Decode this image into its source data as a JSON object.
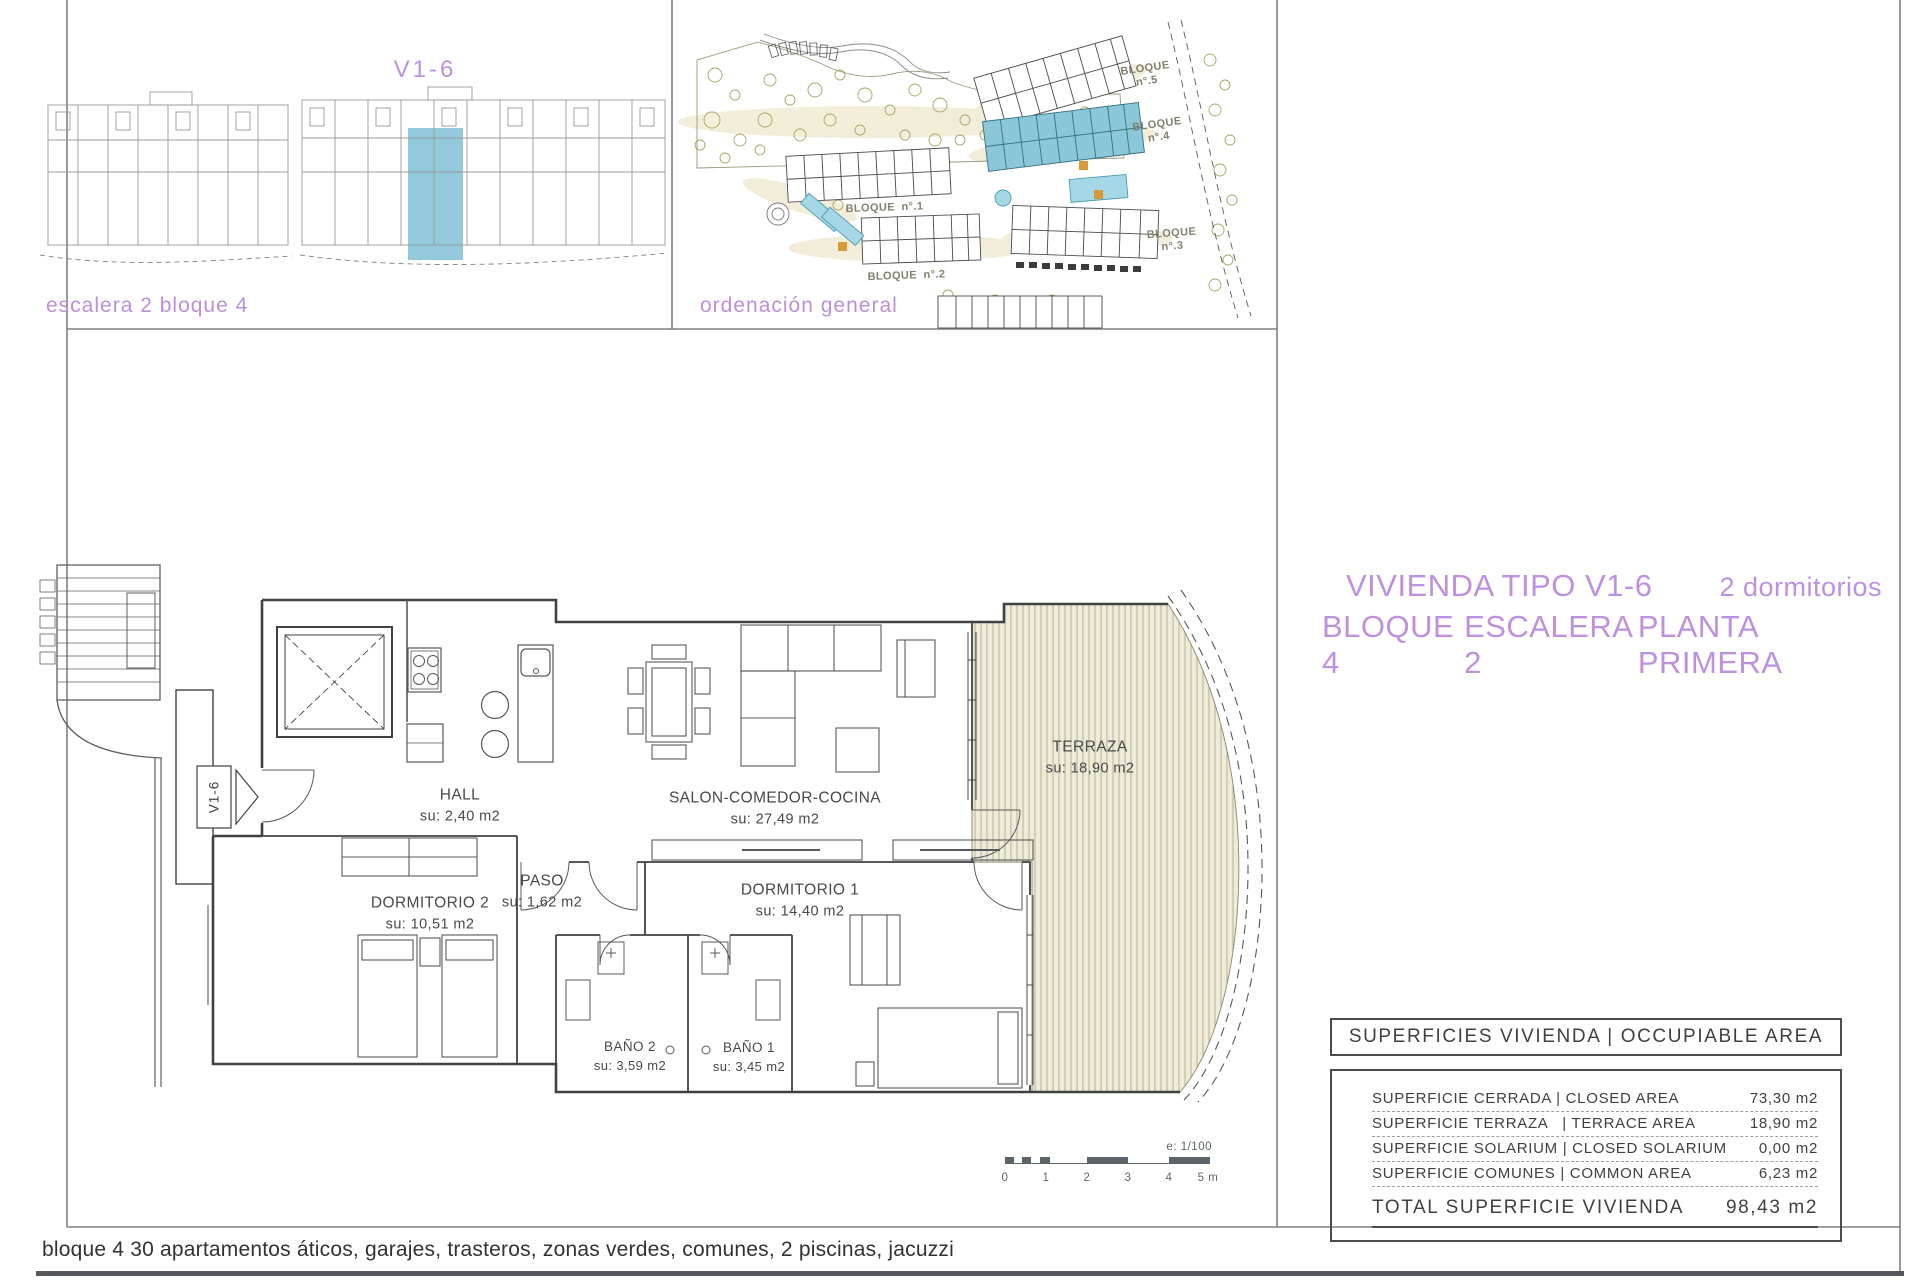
{
  "colors": {
    "accent_purple": "#bd90e0",
    "highlight_blue": "#89c6d8",
    "terrace_fill": "#efebdb",
    "terrace_hatch": "#b7b18c",
    "ink": "#3f4244",
    "scalebar": "#5a646a"
  },
  "locator_panel": {
    "unit_code": "V1-6",
    "caption": "escalera 2 bloque 4"
  },
  "site_panel": {
    "caption": "ordenación general",
    "blocks": [
      {
        "name": "BLOQUE",
        "no": "n°.5"
      },
      {
        "name": "BLOQUE",
        "no": "n°.4"
      },
      {
        "name": "BLOQUE",
        "no": "n°.1"
      },
      {
        "name": "BLOQUE",
        "no": "n°.2"
      },
      {
        "name": "BLOQUE",
        "no": "n°.3"
      }
    ]
  },
  "title": {
    "type_line": "VIVIENDA TIPO V1-6",
    "bedrooms": "2 dormitorios",
    "location_parts": [
      "BLOQUE 4",
      "ESCALERA 2",
      "PLANTA PRIMERA"
    ]
  },
  "floor_plan": {
    "marker": "V1-6",
    "rooms": {
      "hall": {
        "name": "HALL",
        "area": "su: 2,40 m2"
      },
      "salon": {
        "name": "SALON-COMEDOR-COCINA",
        "area": "su: 27,49 m2"
      },
      "terraza": {
        "name": "TERRAZA",
        "area": "su: 18,90 m2"
      },
      "dormitorio2": {
        "name": "DORMITORIO 2",
        "area": "su: 10,51 m2"
      },
      "paso": {
        "name": "PASO",
        "area": "su: 1,62 m2"
      },
      "dormitorio1": {
        "name": "DORMITORIO 1",
        "area": "su: 14,40 m2"
      },
      "bano2": {
        "name": "BAÑO 2",
        "area": "su: 3,59 m2"
      },
      "bano1": {
        "name": "BAÑO 1",
        "area": "su: 3,45 m2"
      }
    },
    "scale": {
      "ratio": "e: 1/100",
      "ticks": [
        "0",
        "1",
        "2",
        "3",
        "4",
        "5 m"
      ]
    }
  },
  "areas_table": {
    "header": "SUPERFICIES VIVIENDA | OCCUPIABLE AREA",
    "rows": [
      {
        "label": "SUPERFICIE CERRADA | CLOSED AREA",
        "value": "73,30 m2"
      },
      {
        "label": "SUPERFICIE TERRAZA   | TERRACE AREA",
        "value": "18,90 m2"
      },
      {
        "label": "SUPERFICIE SOLARIUM | CLOSED SOLARIUM",
        "value": "0,00 m2"
      },
      {
        "label": "SUPERFICIE COMUNES | COMMON AREA",
        "value": "6,23 m2"
      }
    ],
    "total": {
      "label": "TOTAL SUPERFICIE VIVIENDA",
      "value": "98,43 m2"
    }
  },
  "footer": {
    "note": "bloque 4 30 apartamentos áticos, garajes, trasteros, zonas verdes, comunes, 2 piscinas, jacuzzi"
  }
}
